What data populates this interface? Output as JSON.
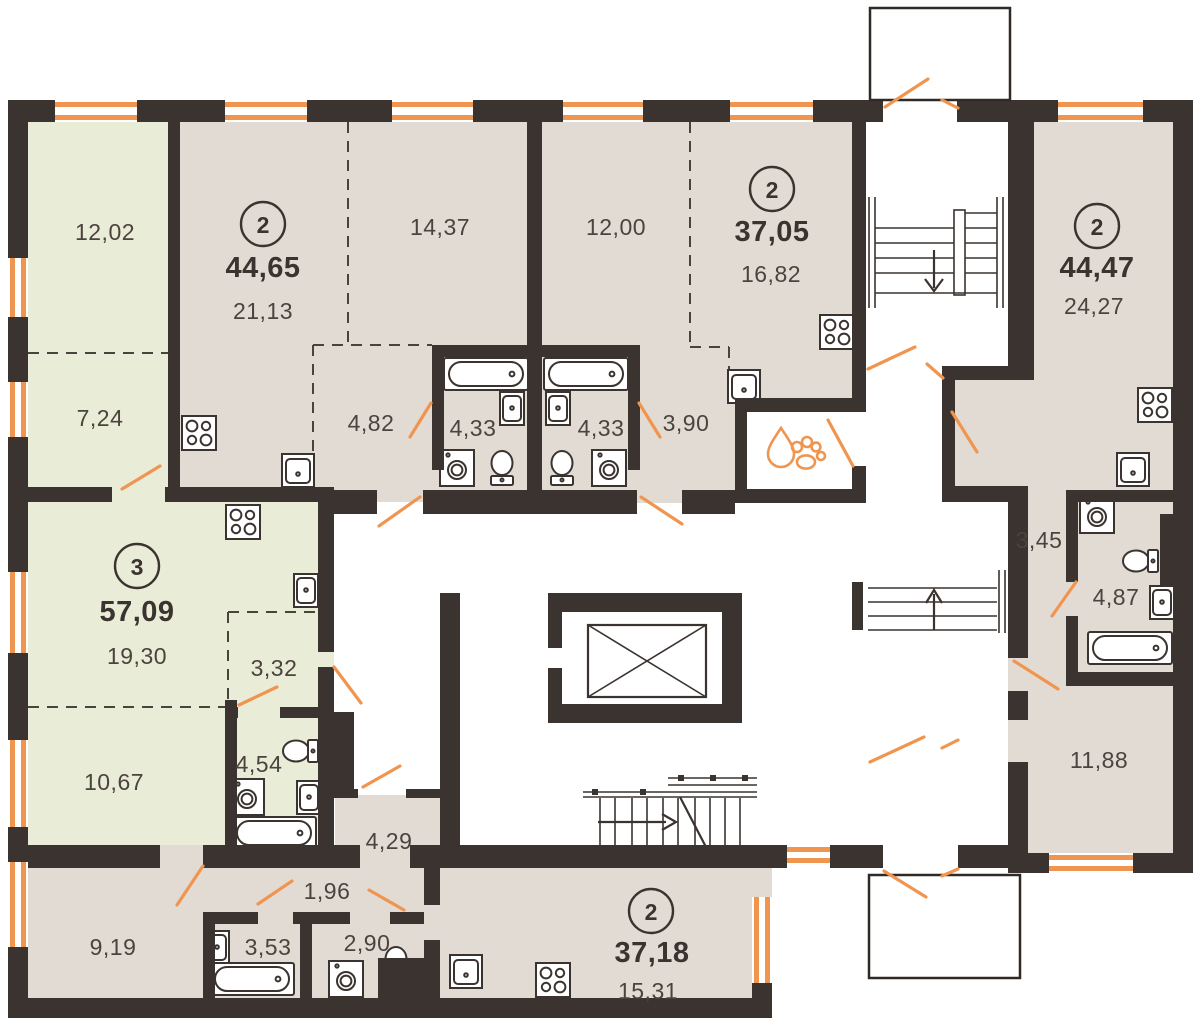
{
  "plan": {
    "canvas": {
      "width": 1201,
      "height": 1026
    },
    "colors": {
      "wall": "#3a332f",
      "accent_orange": "#f0954f",
      "apartment_fill_beige": "#e2dbd4",
      "apartment_fill_green": "#e9ecd7",
      "label_text": "#4b433d"
    },
    "fixture_icons": [
      "bathtub-icon",
      "kitchen-sink-icon",
      "small-sink-icon",
      "toilet-icon",
      "stove-icon",
      "washing-machine-icon",
      "paw-wash-icon",
      "elevator-icon",
      "stairs-icon",
      "door-swing-icon",
      "window-icon"
    ],
    "apartments": [
      {
        "id": "apt-57",
        "badge": "3",
        "total_area": "57,09",
        "badge_pos": {
          "x": 137,
          "y": 566
        },
        "total_pos": {
          "x": 137,
          "y": 612
        },
        "rooms": [
          {
            "area": "12,02",
            "x": 105,
            "y": 232
          },
          {
            "area": "7,24",
            "x": 100,
            "y": 418
          },
          {
            "area": "19,30",
            "x": 137,
            "y": 656
          },
          {
            "area": "3,32",
            "x": 274,
            "y": 668
          },
          {
            "area": "4,54",
            "x": 259,
            "y": 764
          },
          {
            "area": "10,67",
            "x": 114,
            "y": 782
          }
        ]
      },
      {
        "id": "apt-4465",
        "badge": "2",
        "total_area": "44,65",
        "badge_pos": {
          "x": 263,
          "y": 224
        },
        "total_pos": {
          "x": 263,
          "y": 268
        },
        "rooms": [
          {
            "area": "21,13",
            "x": 263,
            "y": 311
          },
          {
            "area": "14,37",
            "x": 440,
            "y": 227
          },
          {
            "area": "4,82",
            "x": 371,
            "y": 423
          },
          {
            "area": "4,33",
            "x": 473,
            "y": 428
          }
        ]
      },
      {
        "id": "apt-3705",
        "badge": "2",
        "total_area": "37,05",
        "badge_pos": {
          "x": 772,
          "y": 189
        },
        "total_pos": {
          "x": 772,
          "y": 232
        },
        "rooms": [
          {
            "area": "12,00",
            "x": 616,
            "y": 227
          },
          {
            "area": "16,82",
            "x": 771,
            "y": 274
          },
          {
            "area": "4,33",
            "x": 601,
            "y": 428
          },
          {
            "area": "3,90",
            "x": 686,
            "y": 423
          }
        ]
      },
      {
        "id": "apt-4447",
        "badge": "2",
        "total_area": "44,47",
        "badge_pos": {
          "x": 1097,
          "y": 226
        },
        "total_pos": {
          "x": 1097,
          "y": 268
        },
        "rooms": [
          {
            "area": "24,27",
            "x": 1094,
            "y": 306
          },
          {
            "area": "3,45",
            "x": 1039,
            "y": 540
          },
          {
            "area": "4,87",
            "x": 1116,
            "y": 597
          },
          {
            "area": "11,88",
            "x": 1099,
            "y": 760
          }
        ]
      },
      {
        "id": "apt-3718",
        "badge": "2",
        "total_area": "37,18",
        "badge_pos": {
          "x": 651,
          "y": 911
        },
        "total_pos": {
          "x": 652,
          "y": 953
        },
        "rooms": [
          {
            "area": "9,19",
            "x": 113,
            "y": 947
          },
          {
            "area": "3,53",
            "x": 268,
            "y": 947
          },
          {
            "area": "2,90",
            "x": 367,
            "y": 943
          },
          {
            "area": "1,96",
            "x": 327,
            "y": 891
          },
          {
            "area": "4,29",
            "x": 389,
            "y": 841
          },
          {
            "area": "15,31",
            "x": 648,
            "y": 991
          }
        ]
      }
    ]
  }
}
